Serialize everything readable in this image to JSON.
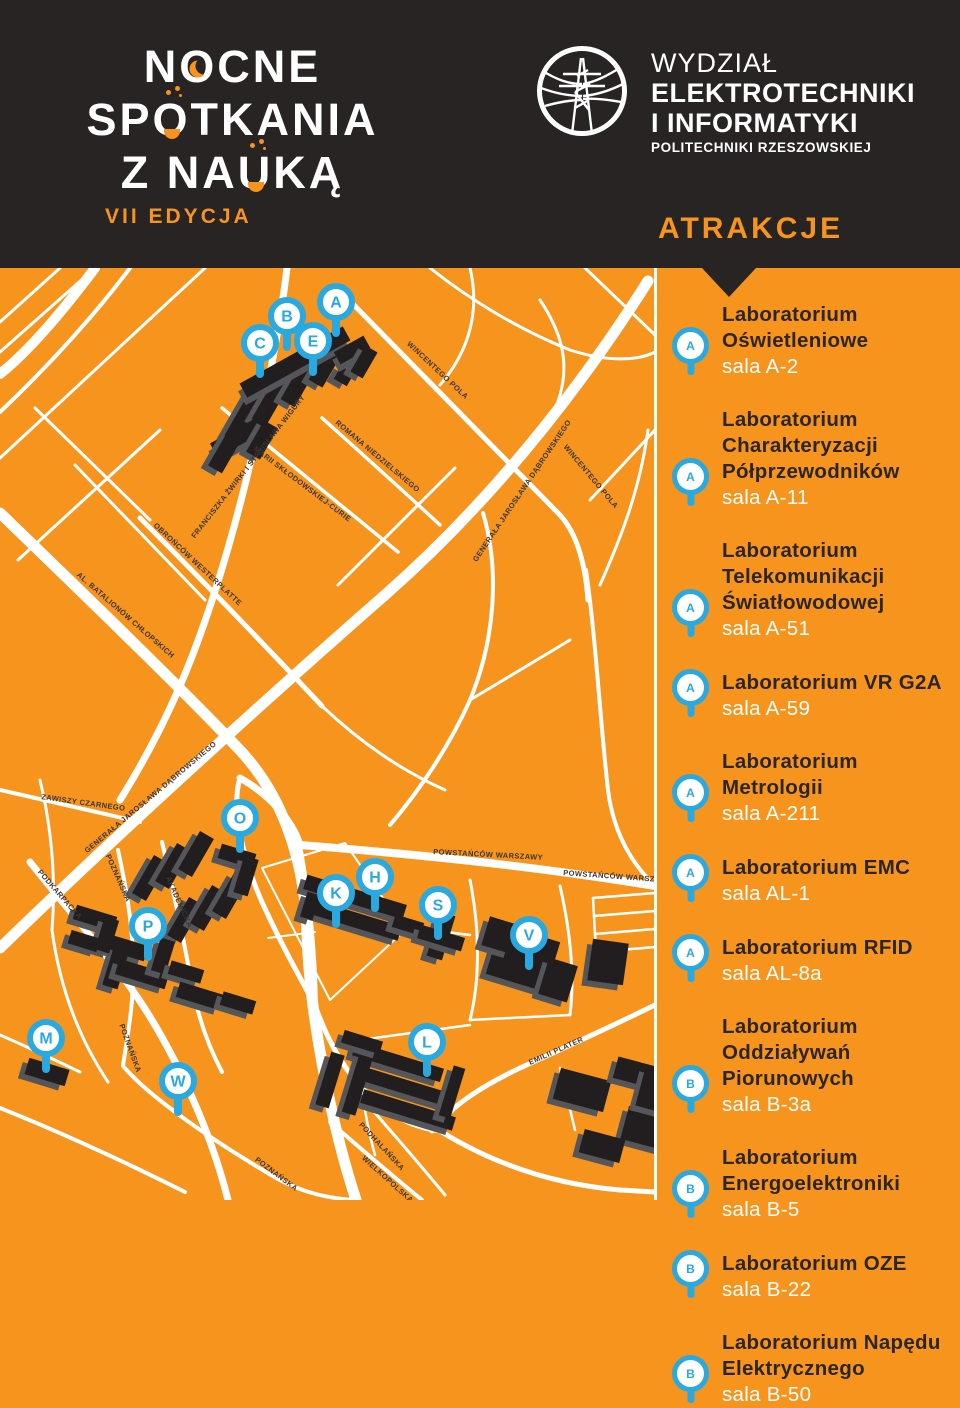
{
  "header": {
    "event_logo": {
      "line1": "NOCNE",
      "line2": "SPOTKANIA",
      "line3": "Z NAUKĄ",
      "edition": "VII EDYCJA"
    },
    "faculty_logo": {
      "line1": "WYDZIAŁ",
      "line2": "ELEKTROTECHNIKI",
      "line3": "I INFORMATYKI",
      "line4": "POLITECHNIKI RZESZOWSKIEJ"
    },
    "attractions_title": "ATRAKCJE"
  },
  "colors": {
    "orange": "#f7941e",
    "dark": "#282424",
    "blue": "#2aa9e1",
    "building": "#221e1f",
    "building_side": "#55565a",
    "road": "#ffffff"
  },
  "map": {
    "markers": [
      {
        "letter": "A",
        "x": 336,
        "y": 302
      },
      {
        "letter": "B",
        "x": 287,
        "y": 316
      },
      {
        "letter": "C",
        "x": 260,
        "y": 343
      },
      {
        "letter": "E",
        "x": 313,
        "y": 341
      },
      {
        "letter": "O",
        "x": 240,
        "y": 818
      },
      {
        "letter": "K",
        "x": 336,
        "y": 893
      },
      {
        "letter": "H",
        "x": 375,
        "y": 877
      },
      {
        "letter": "S",
        "x": 438,
        "y": 905
      },
      {
        "letter": "V",
        "x": 529,
        "y": 935
      },
      {
        "letter": "P",
        "x": 148,
        "y": 926
      },
      {
        "letter": "M",
        "x": 46,
        "y": 1038
      },
      {
        "letter": "W",
        "x": 178,
        "y": 1081
      },
      {
        "letter": "L",
        "x": 427,
        "y": 1042
      }
    ],
    "street_labels": [
      {
        "text": "FRANCISZKA ŻWIRKI I STANISŁAWA WIGURY",
        "x": 250,
        "y": 468,
        "rotate": -52
      },
      {
        "text": "MARII SKŁODOWSKIEJ-CURIE",
        "x": 301,
        "y": 486,
        "rotate": 37
      },
      {
        "text": "ROMANA NIEDZIELSKIEGO",
        "x": 376,
        "y": 458,
        "rotate": 40
      },
      {
        "text": "WINCENTEGO POLA",
        "x": 436,
        "y": 372,
        "rotate": 43
      },
      {
        "text": "WINCENTEGO POLA",
        "x": 589,
        "y": 478,
        "rotate": 50
      },
      {
        "text": "GENERAŁA JAROSŁAWA DĄBROWSKIEGO",
        "x": 524,
        "y": 492,
        "rotate": -56
      },
      {
        "text": "GENERAŁA JAROSŁAWA DĄBROWSKIEGO",
        "x": 152,
        "y": 799,
        "rotate": -40
      },
      {
        "text": "OBROŃCÓW WESTERPLATTE",
        "x": 196,
        "y": 566,
        "rotate": 43
      },
      {
        "text": "AL. BATALIONÓW CHŁOPSKICH",
        "x": 124,
        "y": 617,
        "rotate": 41
      },
      {
        "text": "ZAWISZY CZARNEGO",
        "x": 83,
        "y": 805,
        "rotate": 8
      },
      {
        "text": "PODKARPACKA",
        "x": 58,
        "y": 896,
        "rotate": 49
      },
      {
        "text": "POZNAŃSKA",
        "x": 116,
        "y": 879,
        "rotate": 66
      },
      {
        "text": "AKADEMICKA",
        "x": 177,
        "y": 903,
        "rotate": 66
      },
      {
        "text": "POWSTAŃCÓW WARSZAWY",
        "x": 488,
        "y": 857,
        "rotate": 3
      },
      {
        "text": "POWSTAŃCÓW WARSZAWY",
        "x": 618,
        "y": 879,
        "rotate": 4
      },
      {
        "text": "EMILII PLATER",
        "x": 557,
        "y": 1053,
        "rotate": -24
      },
      {
        "text": "POZNAŃSKA",
        "x": 128,
        "y": 1049,
        "rotate": 70
      },
      {
        "text": "POZNAŃSKA",
        "x": 275,
        "y": 1176,
        "rotate": 37
      },
      {
        "text": "PODHALAŃSKA",
        "x": 380,
        "y": 1148,
        "rotate": 47
      },
      {
        "text": "WIELKOPOLSKA",
        "x": 386,
        "y": 1181,
        "rotate": 42
      }
    ]
  },
  "attractions": [
    {
      "marker": "A",
      "title": "Laboratorium Oświetleniowe",
      "room": "sala A-2"
    },
    {
      "marker": "A",
      "title": "Laboratorium Charakteryzacji Półprzewodników",
      "room": "sala A-11"
    },
    {
      "marker": "A",
      "title": "Laboratorium Telekomunikacji Światłowodowej",
      "room": "sala A-51"
    },
    {
      "marker": "A",
      "title": "Laboratorium VR G2A",
      "room": "sala A-59"
    },
    {
      "marker": "A",
      "title": "Laboratorium Metrologii",
      "room": "sala A-211"
    },
    {
      "marker": "A",
      "title": "Laboratorium EMC",
      "room": "sala AL-1"
    },
    {
      "marker": "A",
      "title": "Laboratorium RFID",
      "room": "sala AL-8a"
    },
    {
      "marker": "B",
      "title": "Laboratorium Oddziaływań Piorunowych",
      "room": "sala B-3a"
    },
    {
      "marker": "B",
      "title": "Laboratorium Energoelektroniki",
      "room": "sala B-5"
    },
    {
      "marker": "B",
      "title": "Laboratorium OZE",
      "room": "sala B-22"
    },
    {
      "marker": "B",
      "title": "Laboratorium Napędu Elektrycznego",
      "room": "sala B-50"
    }
  ]
}
